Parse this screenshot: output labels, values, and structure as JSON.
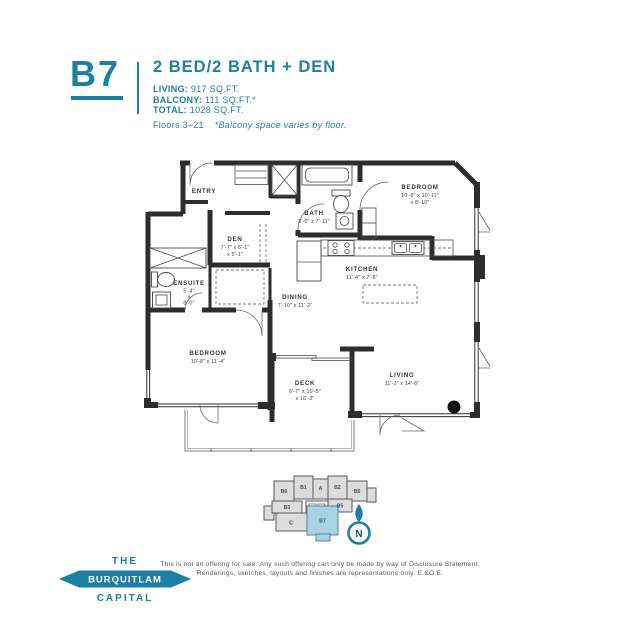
{
  "header": {
    "unit_code": "B7",
    "title": "2 BED/2 BATH + DEN",
    "stats": [
      {
        "label": "LIVING:",
        "value": "917 SQ.FT."
      },
      {
        "label": "BALCONY:",
        "value": "111 SQ.FT.*"
      },
      {
        "label": "TOTAL:",
        "value": "1028 SQ.FT."
      }
    ],
    "floors": "Floors 3–21",
    "note": "*Balcony space varies by floor."
  },
  "plan": {
    "rooms": {
      "entry": {
        "name": "ENTRY"
      },
      "den": {
        "name": "DEN",
        "dim1": "7'-7\" x 6'-1\"",
        "dim2": "x 5'-1\""
      },
      "bath": {
        "name": "BATH",
        "dim1": "5'-0\" x 7'-11\""
      },
      "bedroom_top": {
        "name": "BEDROOM",
        "dim1": "10'-6\" x 10'-11\"",
        "dim2": "x 8'-10\""
      },
      "ensuite": {
        "name": "ENSUITE",
        "dim1": "5'-4\"",
        "dim2": "x",
        "dim3": "8'-0\""
      },
      "kitchen": {
        "name": "KITCHEN",
        "dim1": "11'-4\" x 7'-8\""
      },
      "dining": {
        "name": "DINING",
        "dim1": "7'-10\" x 11'-2\""
      },
      "bedroom_left": {
        "name": "BEDROOM",
        "dim1": "10'-8\" x 11'-4\""
      },
      "deck": {
        "name": "DECK",
        "dim1": "6'-7\" x 10'-5\"",
        "dim2": "x 16'-3\""
      },
      "living": {
        "name": "LIVING",
        "dim1": "11'-2\" x 14'-8\""
      }
    }
  },
  "keyplan": {
    "units": [
      {
        "id": "B6"
      },
      {
        "id": "B1"
      },
      {
        "id": "A"
      },
      {
        "id": "B2"
      },
      {
        "id": "B6"
      },
      {
        "id": "B3"
      },
      {
        "id": "B5"
      },
      {
        "id": "C"
      },
      {
        "id": "B7",
        "highlighted": true
      }
    ],
    "north_label": "N"
  },
  "logo": {
    "line1": "THE",
    "line2": "BURQUITLAM",
    "line3": "CAPITAL"
  },
  "disclaimer": {
    "line1": "This is not an offering for sale. Any such offering can only be made by way of Disclosure Statement.",
    "line2": "Renderings, sketches, layouts and finishes are representations only. E.&O.E."
  },
  "colors": {
    "accent": "#1d7fa4",
    "wall": "#2d2d2d",
    "keyplan_highlight": "#a9d3e5"
  }
}
